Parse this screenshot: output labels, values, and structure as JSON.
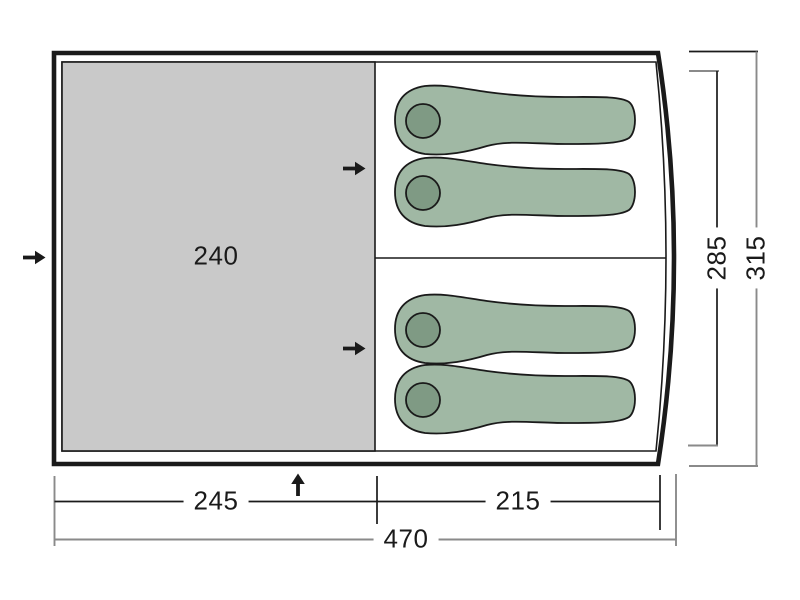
{
  "diagram": {
    "title": "tent floor plan",
    "dimensions": {
      "porch_width": "240",
      "porch_length": "245",
      "cabin_length": "215",
      "total_length": "470",
      "inner_depth": "285",
      "total_depth": "315"
    },
    "features": {
      "sleeping_bag_count": 4,
      "sleeping_cabin_count": 2,
      "entrance_arrow_count": 4
    },
    "colors": {
      "ink": "#1a1a1a",
      "dim": "#8a8a8a",
      "porch": "#c9c9c9",
      "bag": "#a0b8a4",
      "pillow": "#7f9a84",
      "bg": "#ffffff"
    }
  }
}
